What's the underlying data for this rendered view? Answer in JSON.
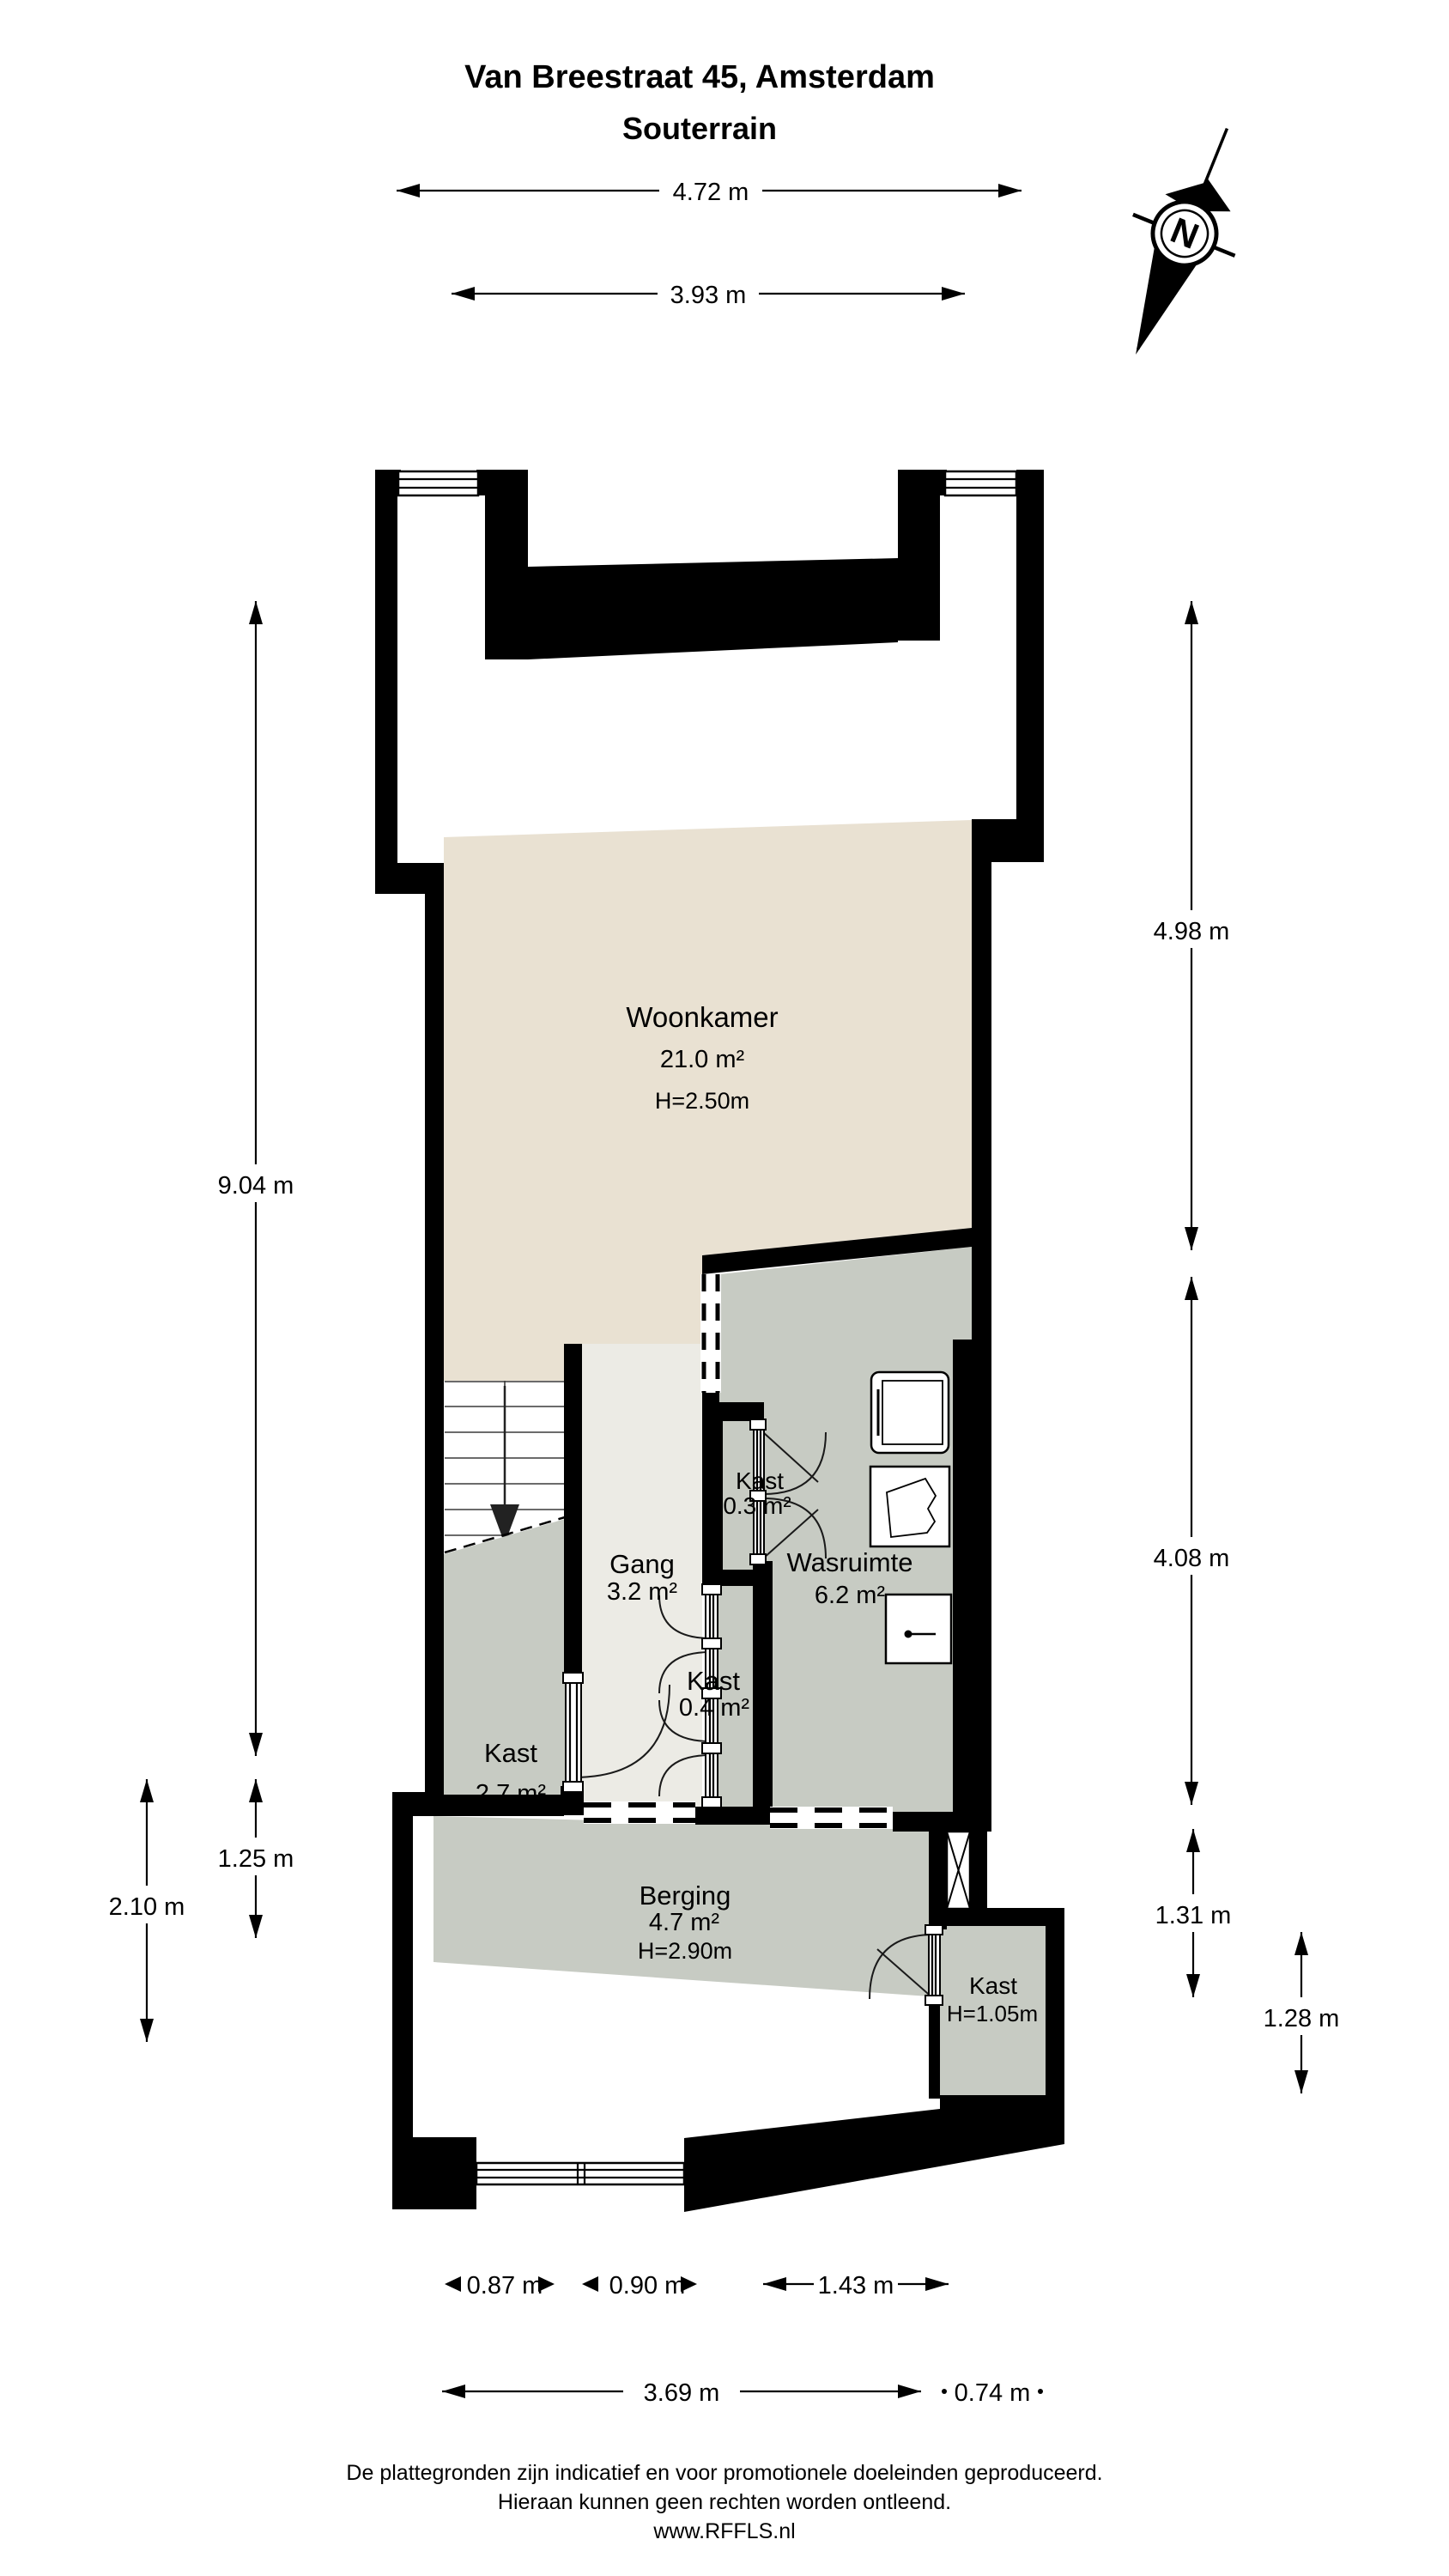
{
  "title": {
    "line1": "Van Breestraat 45, Amsterdam",
    "line2": "Souterrain"
  },
  "compass": {
    "label": "N"
  },
  "rooms": {
    "woonkamer": {
      "name": "Woonkamer",
      "area": "21.0 m²",
      "height": "H=2.50m"
    },
    "gang": {
      "name": "Gang",
      "area": "3.2 m²"
    },
    "kast_klein": {
      "name": "Kast",
      "area": "0.3 m²"
    },
    "wasruimte": {
      "name": "Wasruimte",
      "area": "6.2 m²"
    },
    "kast_trap": {
      "name": "Kast",
      "area": "2.7 m²"
    },
    "kast_gang": {
      "name": "Kast",
      "area": "0.4 m²"
    },
    "berging": {
      "name": "Berging",
      "area": "4.7 m²",
      "height": "H=2.90m"
    },
    "kast_laag": {
      "name": "Kast",
      "height": "H=1.05m"
    }
  },
  "dimensions": {
    "top": [
      {
        "label": "4.72 m"
      },
      {
        "label": "3.93 m"
      }
    ],
    "left": [
      {
        "label": "9.04 m"
      },
      {
        "label": "1.25 m"
      },
      {
        "label": "2.10 m"
      }
    ],
    "right": [
      {
        "label": "4.98 m"
      },
      {
        "label": "4.08 m"
      },
      {
        "label": "1.31 m"
      },
      {
        "label": "1.28 m"
      }
    ],
    "bottom": [
      {
        "label": "0.87 m"
      },
      {
        "label": "0.90 m"
      },
      {
        "label": "1.43 m"
      },
      {
        "label": "3.69 m"
      },
      {
        "label": "0.74 m"
      }
    ]
  },
  "footer": {
    "line1": "De plattegronden zijn indicatief en voor promotionele doeleinden geproduceerd.",
    "line2": "Hieraan kunnen geen rechten worden ontleend.",
    "line3": "www.RFFLS.nl"
  },
  "colors": {
    "wall": "#000000",
    "woonkamer": "#e9e1d2",
    "gang": "#ecebe5",
    "gray_room": "#c7cbc3",
    "background": "#ffffff"
  }
}
